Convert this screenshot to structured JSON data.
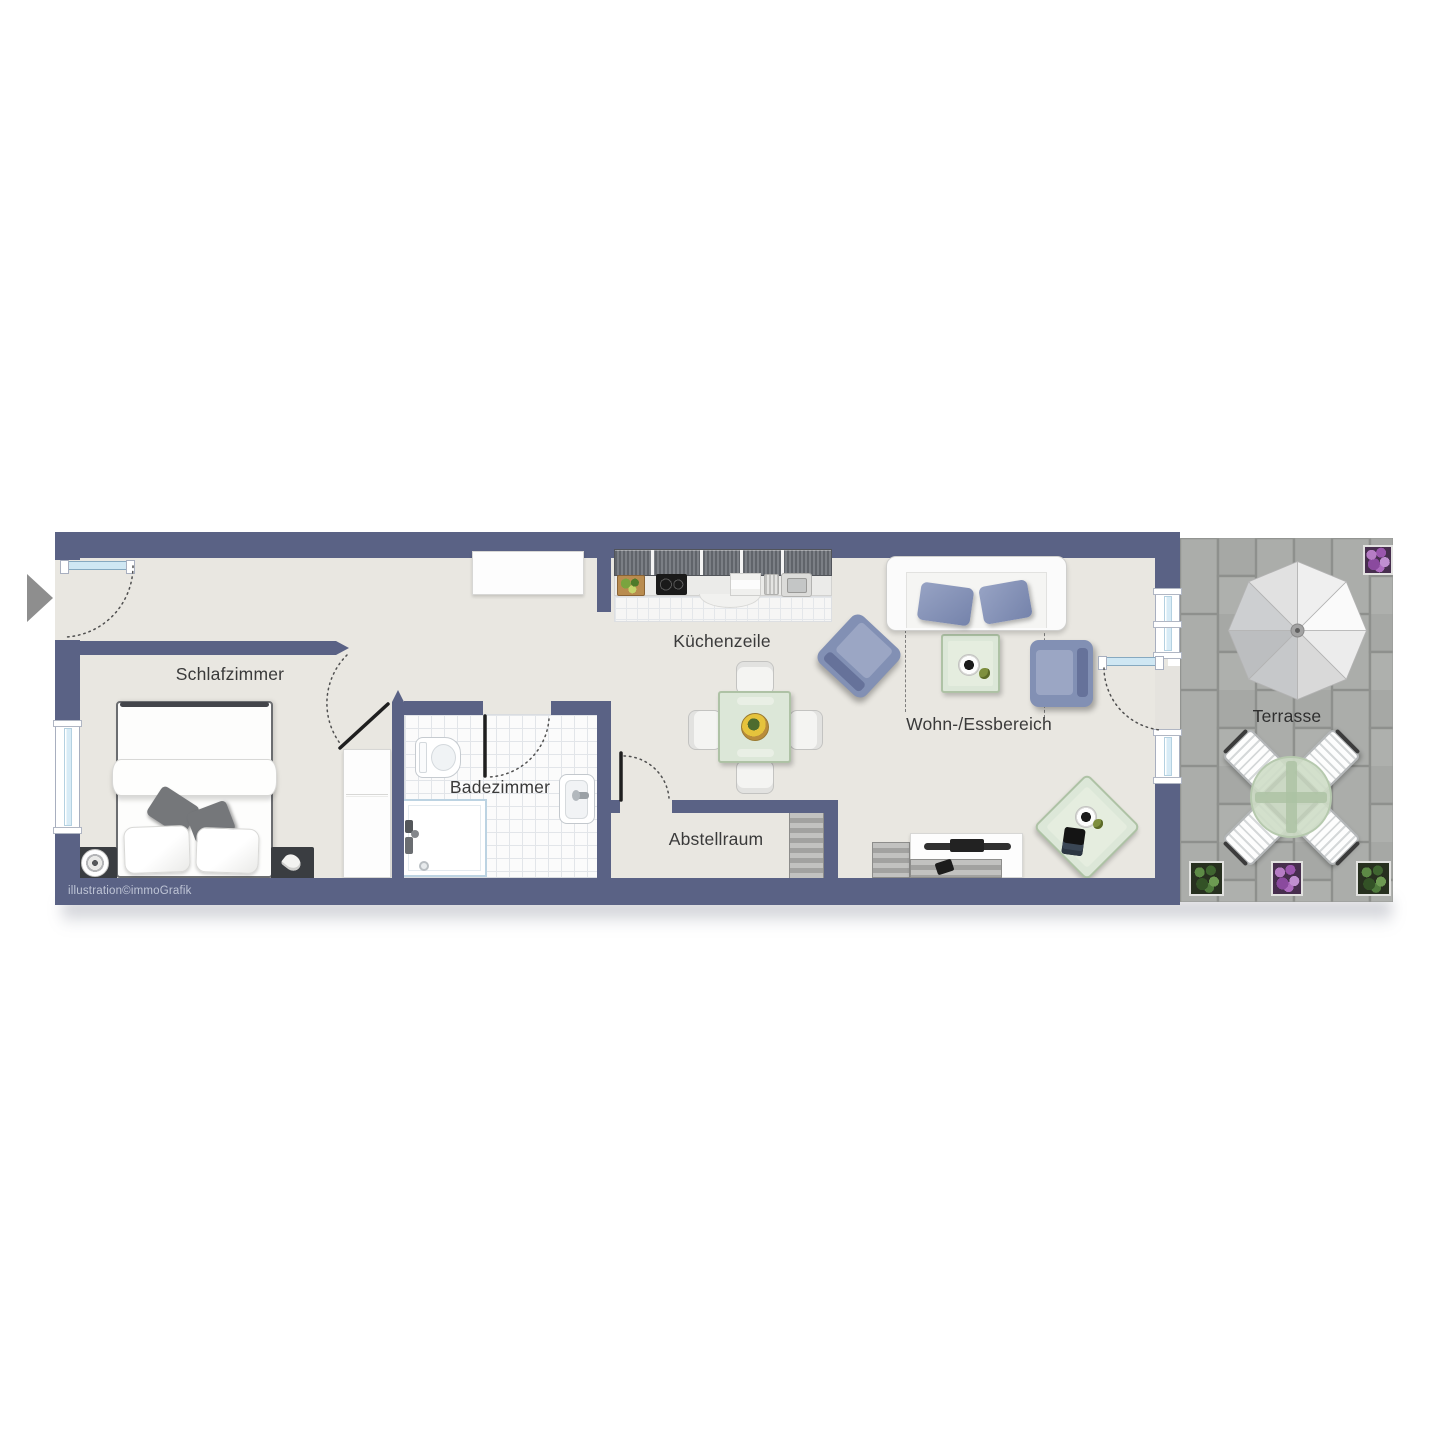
{
  "labels": {
    "schlafzimmer": "Schlafzimmer",
    "badezimmer": "Badezimmer",
    "abstellraum": "Abstellraum",
    "kuechenzeile": "Küchenzeile",
    "wohn_essbereich": "Wohn-/Essbereich",
    "terrasse": "Terrasse"
  },
  "watermark": "illustration©immoGrafik",
  "icons": {
    "entrance": "entrance-arrow"
  },
  "colors": {
    "wall": "#5a6285",
    "floor": "#e9e7e1",
    "bathroom_tiles": "#fbfbfb",
    "terrace_paving": "#a9aba8",
    "upholstery_blue": "#8290b4",
    "table_green": "#dce7d8",
    "window_glass": "#d7ebf6",
    "flowers_purple": "#9a56ad",
    "plants_green": "#4f7a3c",
    "door_swing_line": "#4f4f4f"
  }
}
